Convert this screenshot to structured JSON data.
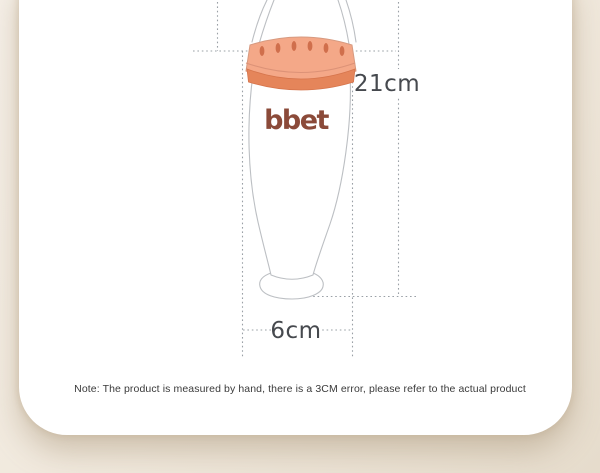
{
  "bottle": {
    "brand": "bbet"
  },
  "labels": {
    "height": "21cm",
    "width": "6cm"
  },
  "note": {
    "text": "Note: The product is measured by hand, there is a 3CM error, please refer to the actual product"
  },
  "colors": {
    "cap": "#f4a888",
    "cap_slot": "#d06f4c",
    "cap_lip": "#dc9277",
    "collar": "#e5855a",
    "logo": "#8b4a39",
    "outline": "#bcbfc3",
    "dimension": "#9aa0a6",
    "label_text": "#46494e",
    "page_bg": "#efe7da",
    "card_bg": "#ffffff"
  }
}
